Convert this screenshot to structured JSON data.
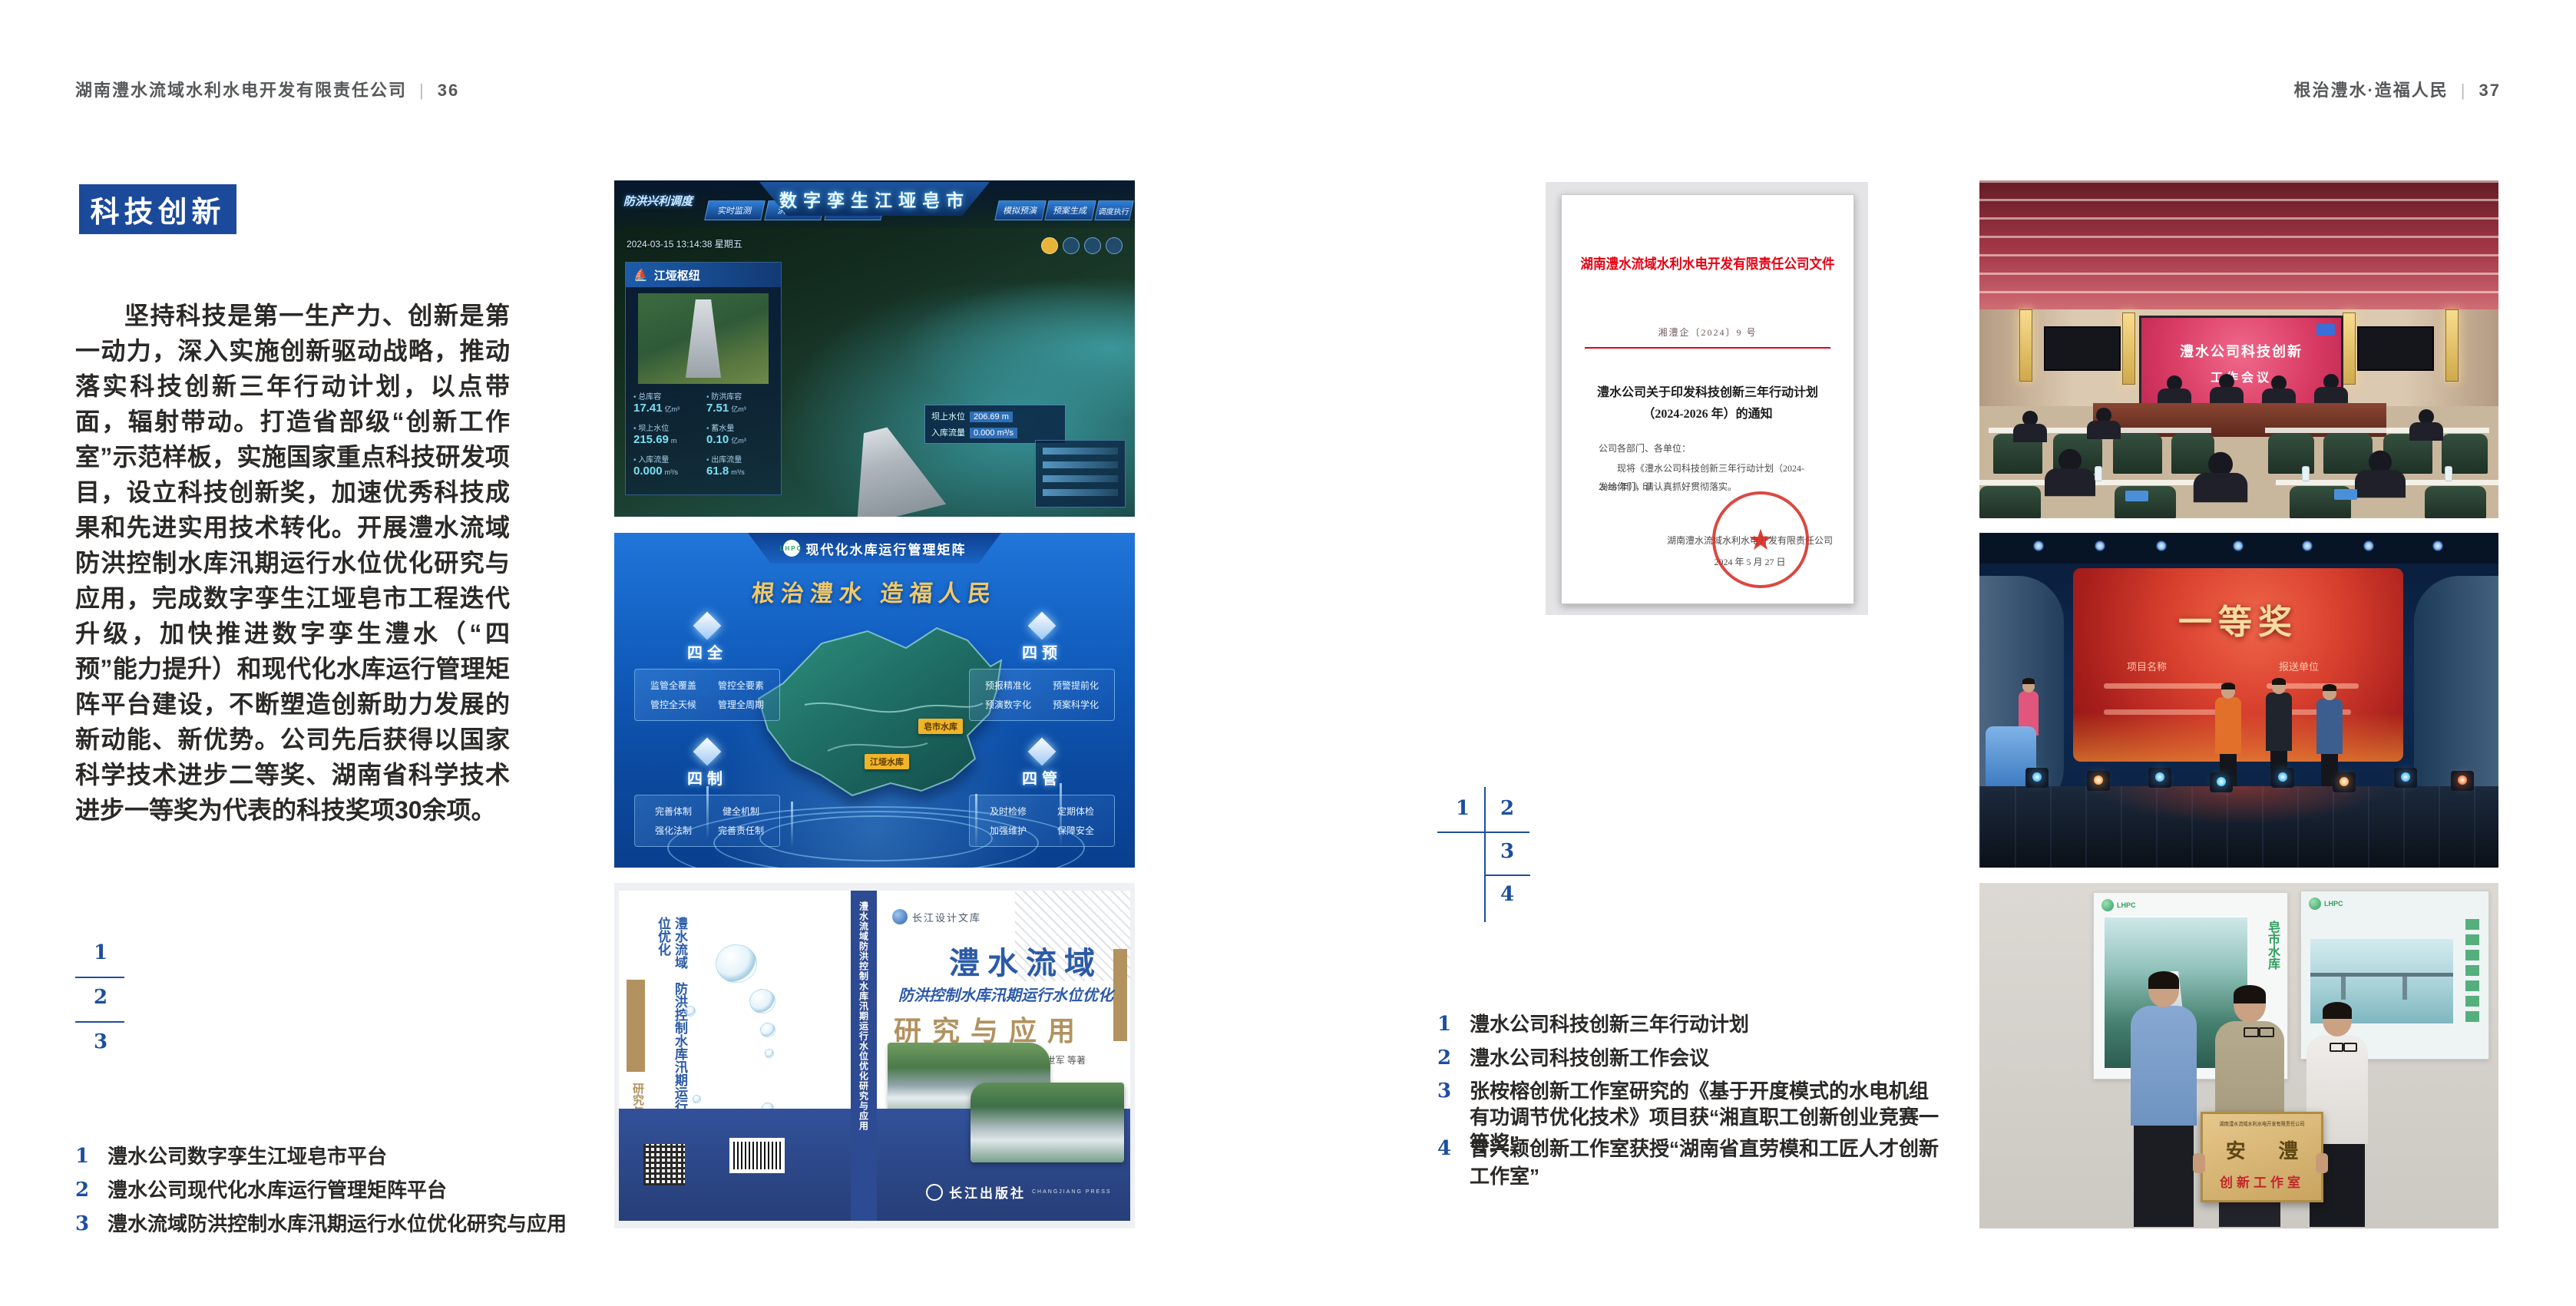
{
  "colors": {
    "accent_blue": "#1b4a9b",
    "index_blue": "#1d4e9e",
    "header_gray": "#57585a",
    "doc_red": "#e60012",
    "seal_red": "#d5281e",
    "book_blue": "#2d4b92",
    "book_tan": "#b2925f"
  },
  "left_page": {
    "header": {
      "company": "湖南澧水流域水利水电开发有限责任公司",
      "separator": "|",
      "page_number": "36"
    },
    "section_title": "科技创新",
    "paragraph": "坚持科技是第一生产力、创新是第一动力，深入实施创新驱动战略，推动落实科技创新三年行动计划，以点带面，辐射带动。打造省部级“创新工作室”示范样板，实施国家重点科技研发项目，设立科技创新奖，加速优秀科技成果和先进实用技术转化。开展澧水流域防洪控制水库汛期运行水位优化研究与应用，完成数字孪生江垭皂市工程迭代升级，加快推进数字孪生澧水（“四预”能力提升）和现代化水库运行管理矩阵平台建设，不断塑造创新助力发展的新动能、新优势。公司先后获得以国家科学技术进步二等奖、湖南省科学技术进步一等奖为代表的科技奖项30余项。",
    "figure_numbers": [
      "1",
      "2",
      "3"
    ],
    "captions": [
      {
        "num": "1",
        "text": "澧水公司数字孪生江垭皂市平台"
      },
      {
        "num": "2",
        "text": "澧水公司现代化水库运行管理矩阵平台"
      },
      {
        "num": "3",
        "text": "澧水流域防洪控制水库汛期运行水位优化研究与应用"
      }
    ]
  },
  "figures": {
    "digital_twin": {
      "corner_label": "防洪兴利调度",
      "tabs_left": [
        "实时监测",
        "洪水预报",
        "防汛预案"
      ],
      "title": "数字孪生江垭皂市",
      "tabs_right": [
        "模拟预演",
        "预案生成",
        "调度执行",
        "工程巡视"
      ],
      "timestamp": "2024-03-15 13:14:38 星期五",
      "panel_title": "江垭枢纽",
      "stats": [
        {
          "label": "总库容",
          "value": "17.41",
          "unit": "亿m³"
        },
        {
          "label": "防洪库容",
          "value": "7.51",
          "unit": "亿m³"
        },
        {
          "label": "坝上水位",
          "value": "215.69",
          "unit": "m"
        },
        {
          "label": "蓄水量",
          "value": "0.10",
          "unit": "亿m³"
        },
        {
          "label": "入库流量",
          "value": "0.000",
          "unit": "m³/s"
        },
        {
          "label": "出库流量",
          "value": "61.8",
          "unit": "m³/s"
        }
      ],
      "map_tag": {
        "label1": "坝上水位",
        "value1": "206.69 m",
        "label2": "入库流量",
        "value2": "0.000 m³/s"
      }
    },
    "matrix": {
      "logo": "LHPC",
      "title": "现代化水库运行管理矩阵",
      "slogan": "根治澧水 造福人民",
      "quadrants": [
        {
          "name": "四全",
          "items": [
            "监管全覆盖",
            "管控全要素",
            "管控全天候",
            "管理全周期"
          ]
        },
        {
          "name": "四预",
          "items": [
            "预报精准化",
            "预警提前化",
            "预演数字化",
            "预案科学化"
          ]
        },
        {
          "name": "四制",
          "items": [
            "完善体制",
            "健全机制",
            "强化法制",
            "完善责任制"
          ]
        },
        {
          "name": "四管",
          "items": [
            "及时检修",
            "定期体检",
            "加强维护",
            "保障安全"
          ]
        }
      ],
      "map_labels": [
        "皂市水库",
        "江垭水库"
      ]
    },
    "book": {
      "series": "长江设计文库",
      "title_main": "澧水流域",
      "title_sub": "防洪控制水库汛期运行水位优化",
      "title_tail": "研究与应用",
      "authors": "洪兴骏 沈坤民 鲁军 刘世军 等著",
      "spine_text": "澧水流域防洪控制水库汛期运行水位优化研究与应用",
      "publisher": "长江出版社",
      "publisher_en": "CHANGJIANG PRESS"
    }
  },
  "right_page": {
    "header": {
      "slogan": "根治澧水·造福人民",
      "separator": "|",
      "page_number": "37"
    },
    "document": {
      "title": "湖南澧水流域水利水电开发有限责任公司文件",
      "doc_number": "湘澧企〔2024〕9 号",
      "subject_line1": "澧水公司关于印发科技创新三年行动计划",
      "subject_line2": "（2024-2026 年）的通知",
      "salutation": "公司各部门、各单位：",
      "body_line1": "现将《澧水公司科技创新三年行动计划（2024-2026 年）》印",
      "body_line2": "发给你们，请认真抓好贯彻落实。",
      "signer": "湖南澧水流域水利水电开发有限责任公司",
      "date": "2024 年 5 月 27 日"
    },
    "figure_numbers": [
      "1",
      "2",
      "3",
      "4"
    ],
    "captions": [
      {
        "num": "1",
        "text": "澧水公司科技创新三年行动计划"
      },
      {
        "num": "2",
        "text": "澧水公司科技创新工作会议"
      },
      {
        "num": "3",
        "text": "张桉榕创新工作室研究的《基于开度模式的水电机组有功调节优化技术》项目获“湘直职工创新创业竞赛一等奖”"
      },
      {
        "num": "4",
        "text": "曾兴颖创新工作室获授“湖南省直劳模和工匠人才创新工作室”"
      }
    ],
    "photos": {
      "meeting": {
        "screen_line1": "澧水公司科技创新",
        "screen_line2": "工作会议"
      },
      "award": {
        "screen_title": "一等奖",
        "column1": "项目名称",
        "column2": "报送单位"
      },
      "plaque": {
        "header": "湖南澧水流域水利水电开发有限责任公司",
        "name": "安 澧",
        "subtitle": "创新工作室",
        "poster_label": "皂市水库",
        "poster_logo": "LHPC"
      }
    }
  }
}
